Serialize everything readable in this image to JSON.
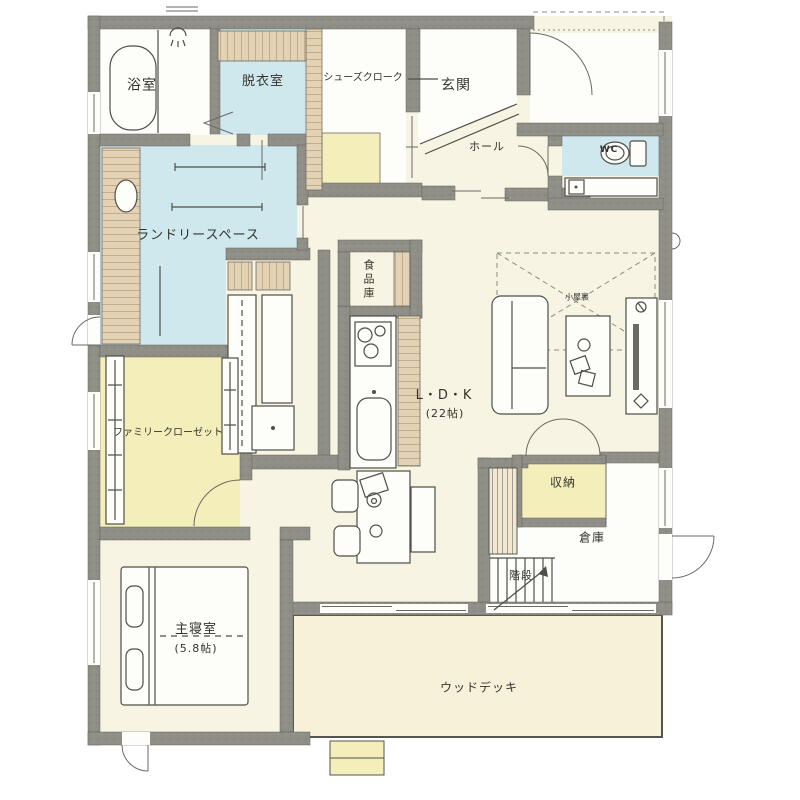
{
  "rooms": {
    "bath": {
      "label": "浴室"
    },
    "dressing": {
      "label": "脱衣室"
    },
    "shoe_cloak": {
      "label": "シューズクローク"
    },
    "entrance": {
      "label": "玄関"
    },
    "hall": {
      "label": "ホール"
    },
    "wc": {
      "label": "WC"
    },
    "laundry": {
      "label": "ランドリースペース"
    },
    "pantry": {
      "label": "食品庫"
    },
    "ldk": {
      "label": "L・D・K",
      "size": "(22帖)"
    },
    "attic_loft": {
      "label": "小屋裏"
    },
    "family_closet": {
      "label": "ファミリークローゼット"
    },
    "storage": {
      "label": "収納"
    },
    "warehouse": {
      "label": "倉庫"
    },
    "stairs": {
      "label": "階段"
    },
    "master_bedroom": {
      "label": "主寝室",
      "size": "(5.8帖)"
    },
    "wood_deck": {
      "label": "ウッドデッキ"
    }
  },
  "colors": {
    "wall_gray": "#8f8f88",
    "floor_cream": "#f8f4e3",
    "water_blue": "#cfe8ee",
    "closet_yellow": "#f4eebb",
    "wood_tan": "#e4d2b4",
    "deck_cream": "#f8f1da",
    "room_white": "#fdfdfa",
    "line_ink": "#4f4f48"
  }
}
